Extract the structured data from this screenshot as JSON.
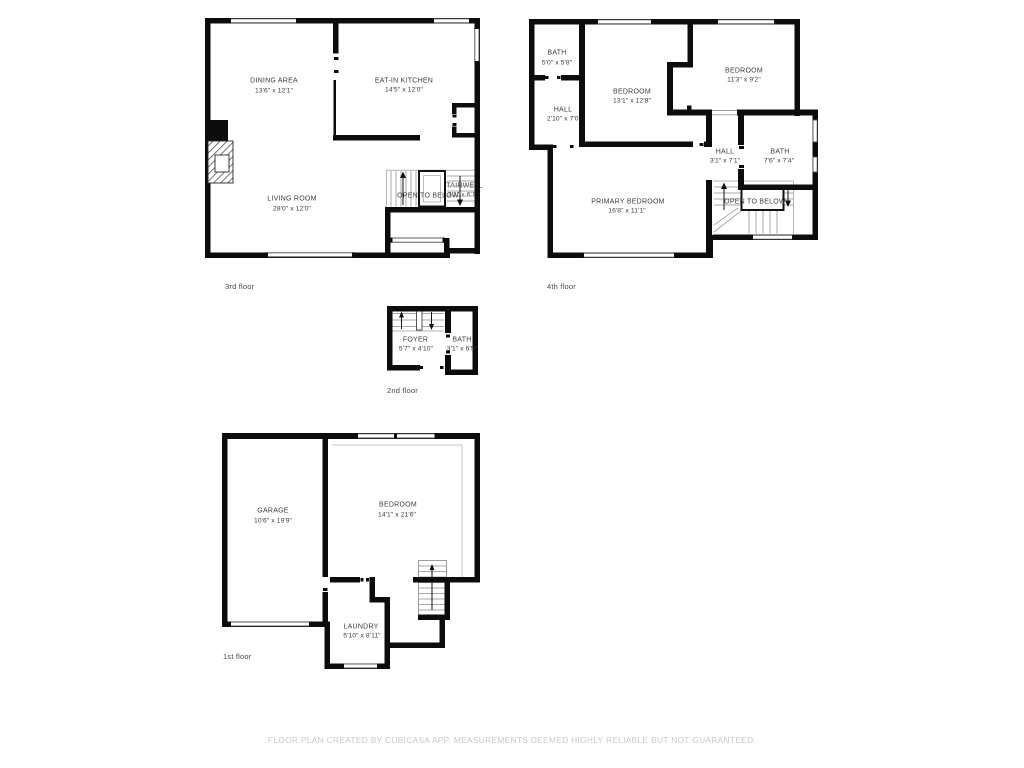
{
  "disclaimer": "FLOOR PLAN CREATED BY CUBICASA APP. MEASUREMENTS DEEMED HIGHLY RELIABLE BUT NOT GUARANTEED.",
  "floors": {
    "third": {
      "caption": "3rd floor",
      "open_to_below": "OPEN TO BELOW",
      "rooms": {
        "dining": {
          "name": "DINING AREA",
          "dims": "13'6\" x 12'1\""
        },
        "kitchen": {
          "name": "EAT-IN KITCHEN",
          "dims": "14'5\" x 12'0\""
        },
        "living": {
          "name": "LIVING ROOM",
          "dims": "28'0\" x 12'0\""
        },
        "stairwell": {
          "name": "STAIRWELL",
          "dims": "3'1\" x 6'1\""
        }
      }
    },
    "fourth": {
      "caption": "4th floor",
      "open_to_below": "OPEN TO BELOW",
      "rooms": {
        "bath_small": {
          "name": "BATH",
          "dims": "5'0\" x 5'8\""
        },
        "hall_left": {
          "name": "HALL",
          "dims": "2'10\" x 7'0\""
        },
        "bedroom_center": {
          "name": "BEDROOM",
          "dims": "13'1\" x 12'8\""
        },
        "bedroom_right": {
          "name": "BEDROOM",
          "dims": "11'3\" x 9'2\""
        },
        "hall_right": {
          "name": "HALL",
          "dims": "3'1\" x 7'1\""
        },
        "bath_right": {
          "name": "BATH",
          "dims": "7'6\" x 7'4\""
        },
        "primary": {
          "name": "PRIMARY BEDROOM",
          "dims": "16'8\" x 11'1\""
        }
      }
    },
    "second": {
      "caption": "2nd floor",
      "rooms": {
        "foyer": {
          "name": "FOYER",
          "dims": "5'7\" x 4'10\""
        },
        "bath": {
          "name": "BATH",
          "dims": "3'1\" x 6'5\""
        }
      }
    },
    "first": {
      "caption": "1st floor",
      "rooms": {
        "garage": {
          "name": "GARAGE",
          "dims": "10'6\" x 19'9\""
        },
        "bedroom": {
          "name": "BEDROOM",
          "dims": "14'1\" x 21'6\""
        },
        "laundry": {
          "name": "LAUNDRY",
          "dims": "5'10\" x 8'11\""
        }
      }
    }
  }
}
